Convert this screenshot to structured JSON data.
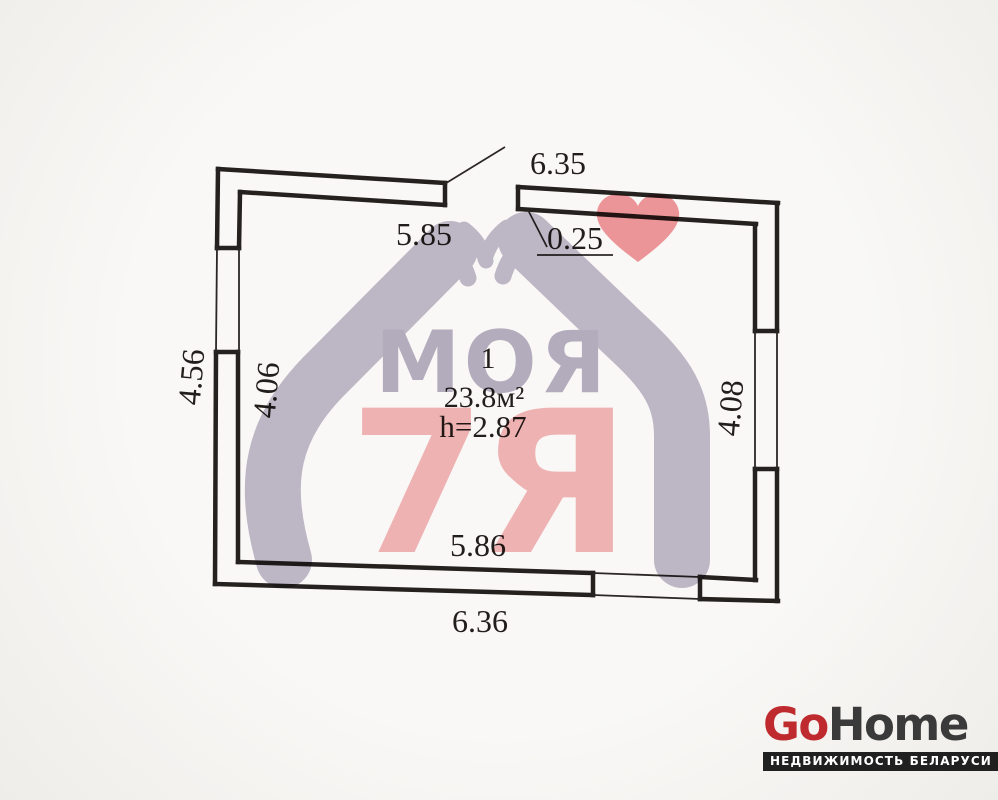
{
  "plan": {
    "room": {
      "number": "1",
      "area": "23.8м²",
      "ceiling_height": "h=2.87"
    },
    "dimensions": {
      "top_width_outer": "6.35",
      "top_width_inner": "5.85",
      "wall_thickness": "0.25",
      "left_height_outer": "4.56",
      "left_height_inner": "4.06",
      "right_height_inner": "4.08",
      "bottom_width_inner": "5.86",
      "bottom_width_outer": "6.36"
    },
    "line_color": "#24211e"
  },
  "watermark": {
    "word": "МОЯ",
    "suffix": "7Я",
    "purple": "#b7b0c4",
    "pink": "#f3abae",
    "heart_color": "#f0878d"
  },
  "logo": {
    "go": "Go",
    "home": "Home",
    "tagline": "НЕДВИЖИМОСТЬ БЕЛАРУСИ",
    "red": "#bf2a2e",
    "dark": "#3a3a3a",
    "bar_bg": "#202020"
  }
}
